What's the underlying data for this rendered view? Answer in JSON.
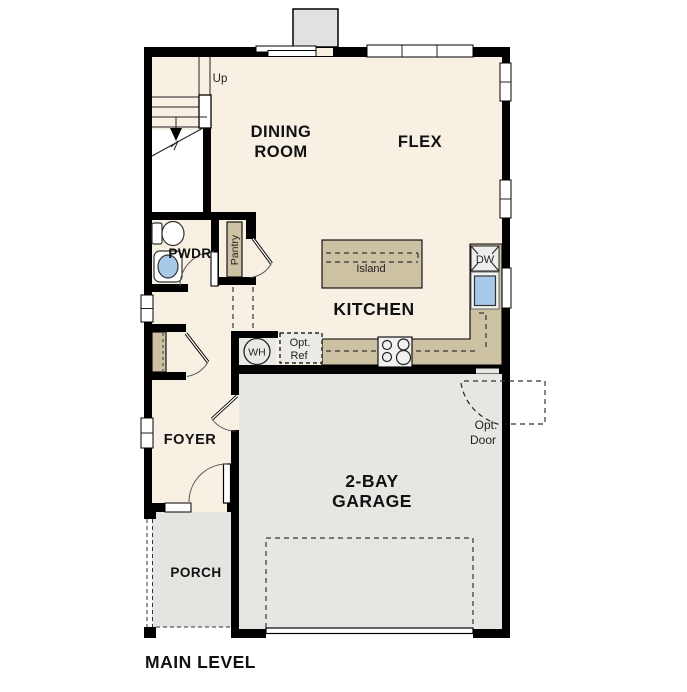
{
  "plan": {
    "title": "MAIN LEVEL",
    "rooms": {
      "dining": {
        "line1": "DINING",
        "line2": "ROOM"
      },
      "flex": "FLEX",
      "kitchen": "KITCHEN",
      "pwdr": "PWDR",
      "pantry": "Pantry",
      "foyer": "FOYER",
      "porch": "PORCH",
      "garage": {
        "line1": "2-BAY",
        "line2": "GARAGE"
      }
    },
    "fixtures": {
      "stair_direction": "Up",
      "island": "Island",
      "dishwasher": "DW",
      "water_heater": "WH",
      "optional_refrigerator": {
        "line1": "Opt.",
        "line2": "Ref"
      },
      "optional_door": {
        "line1": "Opt.",
        "line2": "Door"
      }
    },
    "colors": {
      "wall": "#000000",
      "interior_floor": "#f7f0e3",
      "garage_floor": "#e6e6e3",
      "porch_floor": "#e4e4e1",
      "counter": "#cdc1a3",
      "sink": "#a7c9e8",
      "appliance_box": "#ededeb",
      "chimney": "#e1e1e1"
    }
  }
}
